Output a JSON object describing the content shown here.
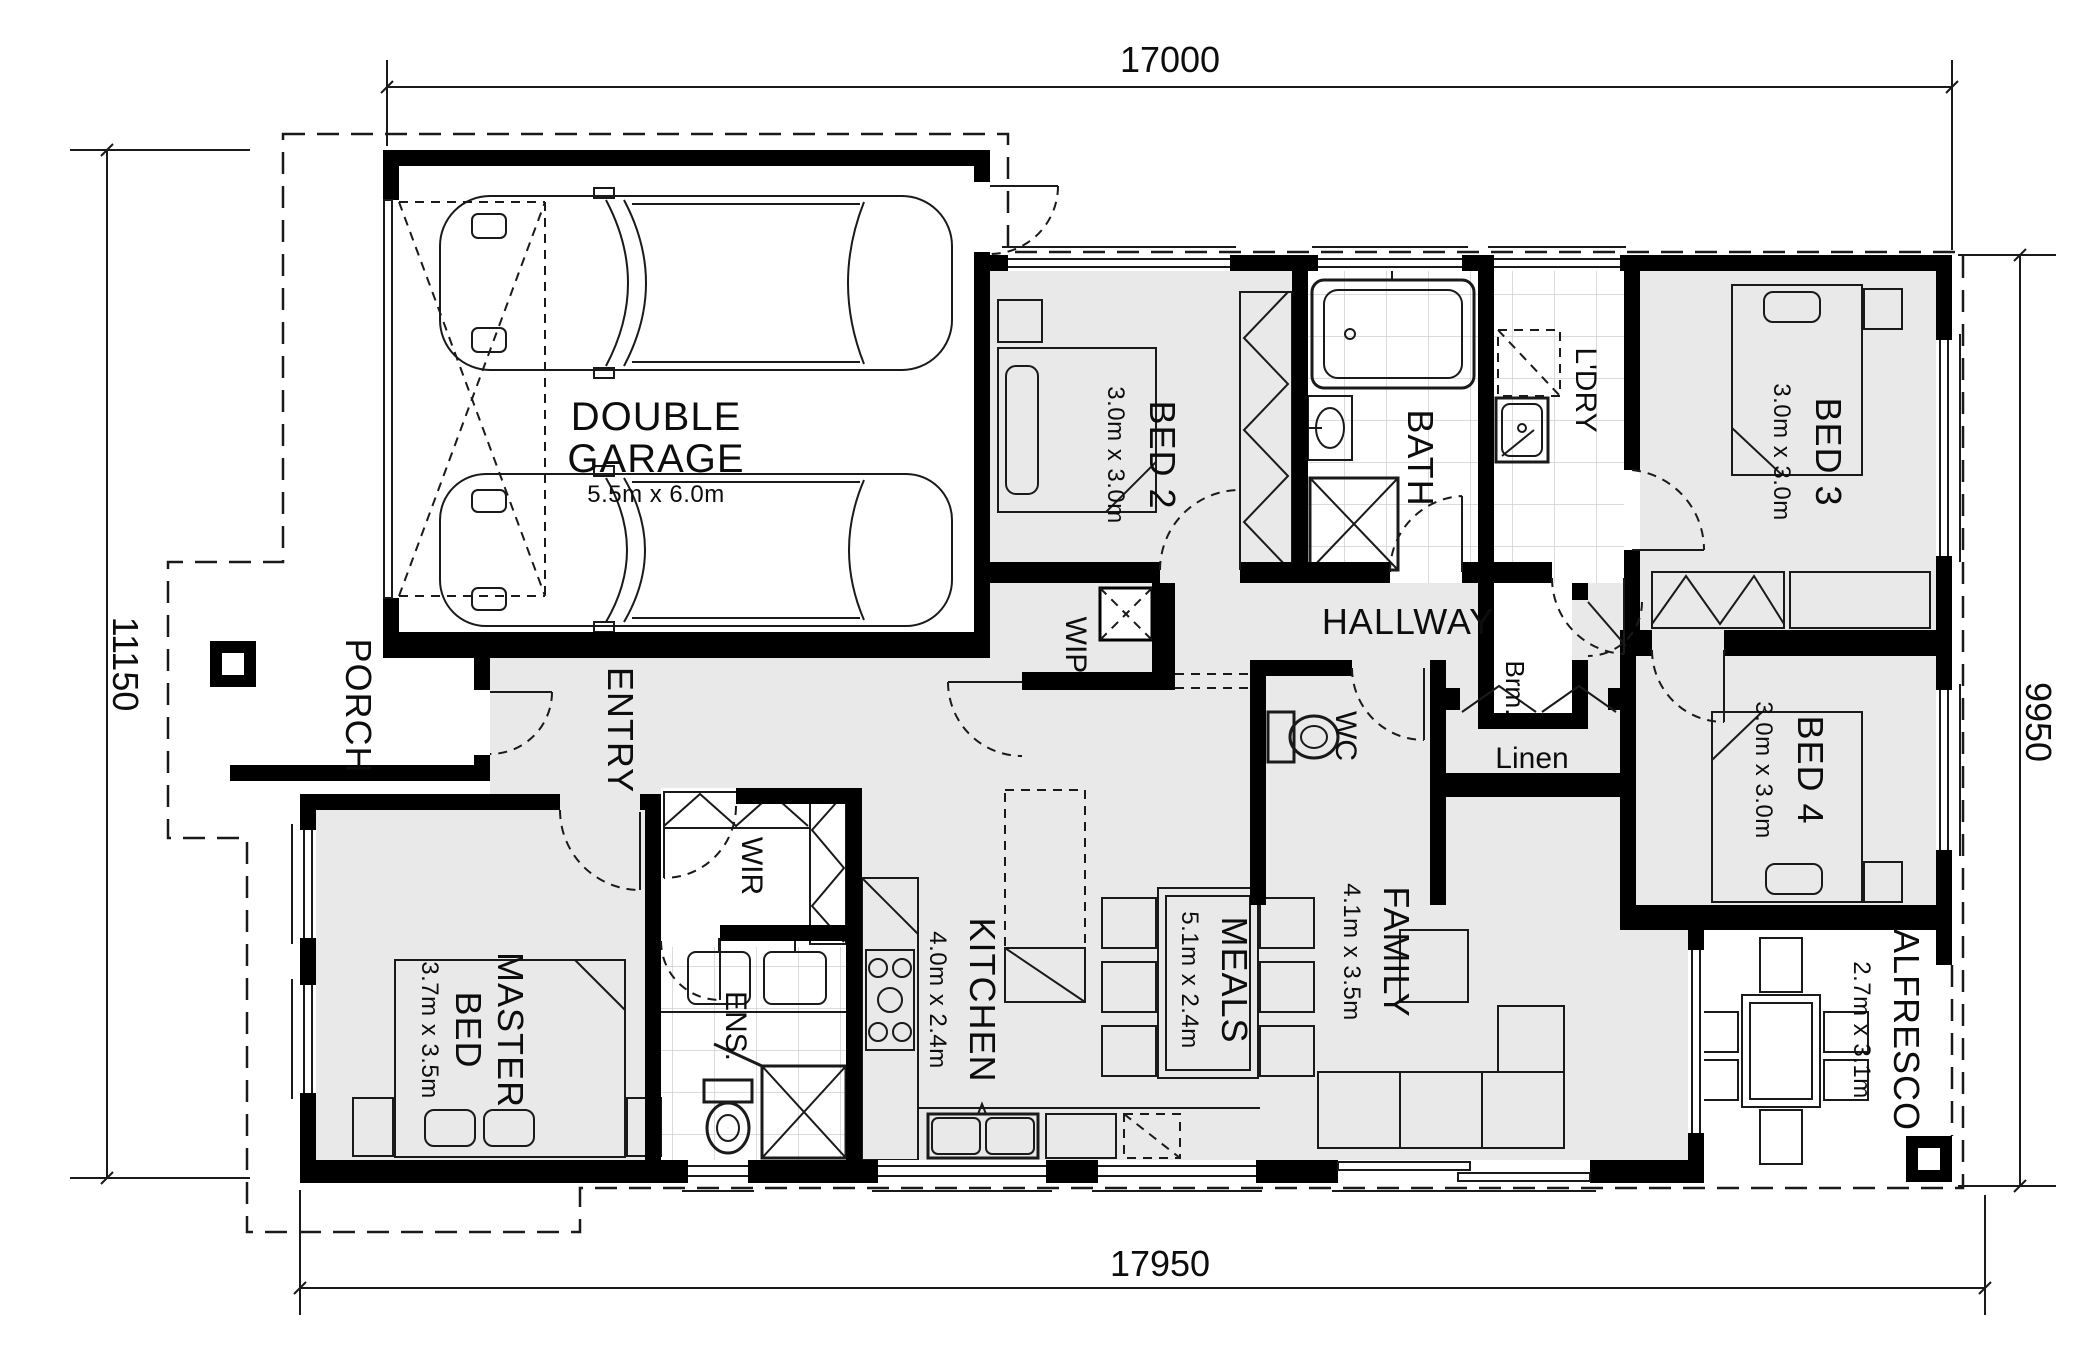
{
  "drawing": {
    "kind": "residential-floor-plan"
  },
  "dimensions": {
    "top": "17000",
    "left": "11150",
    "right": "9950",
    "bottom": "17950"
  },
  "rooms": {
    "garage": {
      "l1": "DOUBLE",
      "l2": "GARAGE",
      "size": "5.5m x 6.0m"
    },
    "bed2": {
      "name": "BED 2",
      "size": "3.0m x 3.0m"
    },
    "bath": {
      "name": "BATH"
    },
    "ldry": {
      "name": "L'DRY"
    },
    "brm": {
      "name": "Brm."
    },
    "bed3": {
      "name": "BED 3",
      "size": "3.0m x 3.0m"
    },
    "hallway": {
      "name": "HALLWAY"
    },
    "wip": {
      "name": "WIP"
    },
    "wc": {
      "name": "WC"
    },
    "linen": {
      "name": "Linen"
    },
    "bed4": {
      "name": "BED 4",
      "size": "3.0m x 3.0m"
    },
    "porch": {
      "name": "PORCH"
    },
    "entry": {
      "name": "ENTRY"
    },
    "wir": {
      "name": "WIR"
    },
    "ens": {
      "name": "ENS."
    },
    "master": {
      "l1": "MASTER",
      "l2": "BED",
      "size": "3.7m x 3.5m"
    },
    "kitchen": {
      "name": "KITCHEN",
      "size": "4.0m x 2.4m"
    },
    "meals": {
      "name": "MEALS",
      "size": "5.1m x 2.4m"
    },
    "family": {
      "name": "FAMILY",
      "size": "4.1m x 3.5m"
    },
    "alfresco": {
      "name": "ALFRESCO",
      "size": "2.7m x 3.1m"
    }
  },
  "colors": {
    "wall": "#000000",
    "floor": "#e9e9e9",
    "line": "#1a1a1a",
    "tile": "#cfcfcf"
  }
}
